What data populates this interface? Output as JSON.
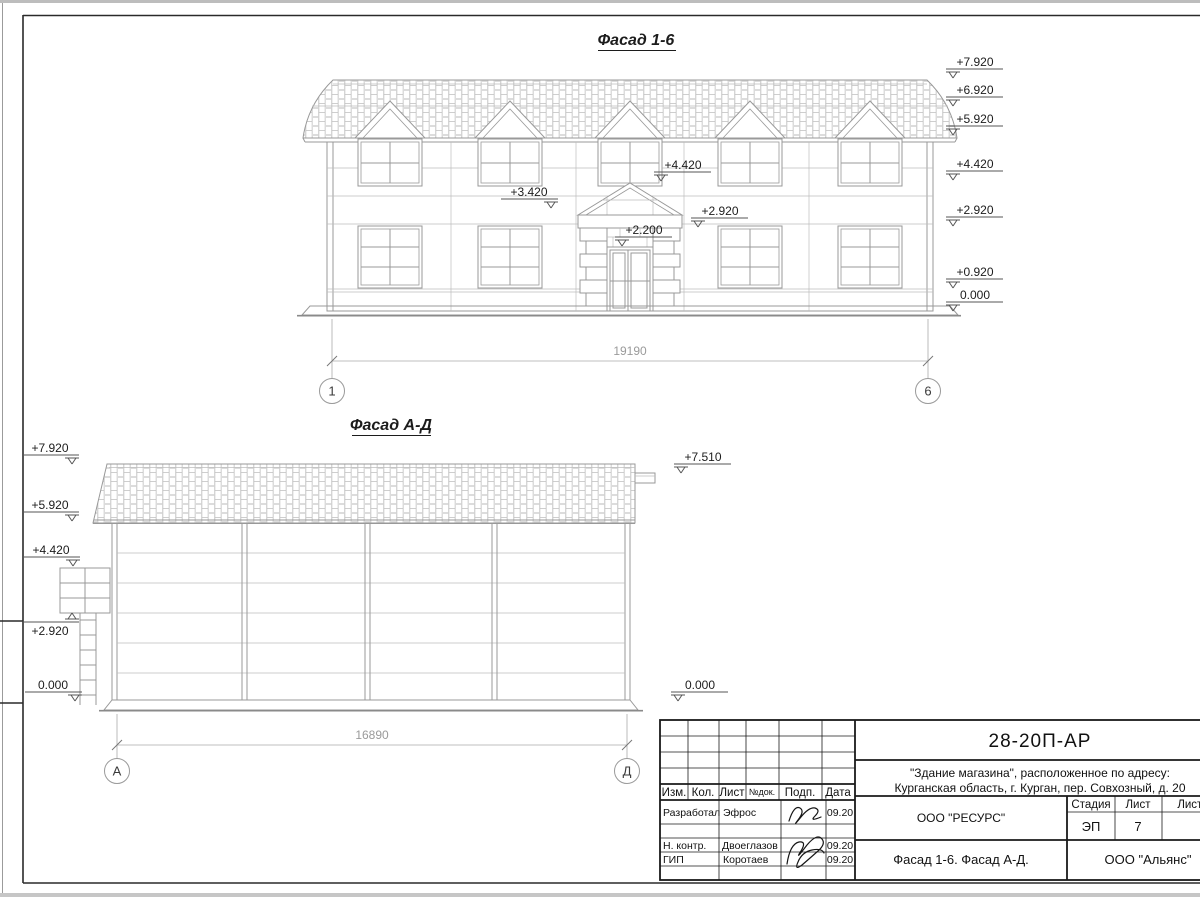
{
  "sheet": {
    "doc_number": "28-20П-АР",
    "project_line1": "\"Здание магазина\", расположенное по адресу:",
    "project_line2": "Курганская область, г. Курган, пер. Совхозный, д. 20",
    "organization": "ООО \"РЕСУРС\"",
    "sheet_title": "Фасад 1-6. Фасад А-Д.",
    "company": "ООО \"Альянс\"",
    "stage_label": "Стадия",
    "stage_value": "ЭП",
    "sheet_label": "Лист",
    "sheet_value": "7",
    "sheets_label": "Листов",
    "columns": [
      "Изм.",
      "Кол.",
      "Лист",
      "№док.",
      "Подп.",
      "Дата"
    ],
    "rows": [
      {
        "role": "Разработал",
        "name": "Эфрос",
        "date": "09.20"
      },
      {
        "role": "Н. контр.",
        "name": "Двоеглазов",
        "date": "09.20"
      },
      {
        "role": "ГИП",
        "name": "Коротаев",
        "date": "09.20"
      }
    ]
  },
  "facade16": {
    "title": "Фасад 1-6",
    "dimension": "19190",
    "axis_left": "1",
    "axis_right": "6",
    "marks_right": [
      "+7.920",
      "+6.920",
      "+5.920",
      "+4.420",
      "+2.920",
      "+0.920",
      "0.000"
    ],
    "marks_inner": [
      "+4.420",
      "+3.420",
      "+2.920",
      "+2.200"
    ]
  },
  "facadeAD": {
    "title": "Фасад А-Д",
    "dimension": "16890",
    "axis_left": "А",
    "axis_right": "Д",
    "marks_left": [
      "+7.920",
      "+5.920",
      "+4.420",
      "+2.920",
      "0.000"
    ],
    "marks_right": [
      "+7.510",
      "0.000"
    ]
  },
  "colors": {
    "building_line": "#999999",
    "dim_line": "#9a9a9a",
    "ink": "#1a1a1a",
    "paper": "#ffffff"
  }
}
